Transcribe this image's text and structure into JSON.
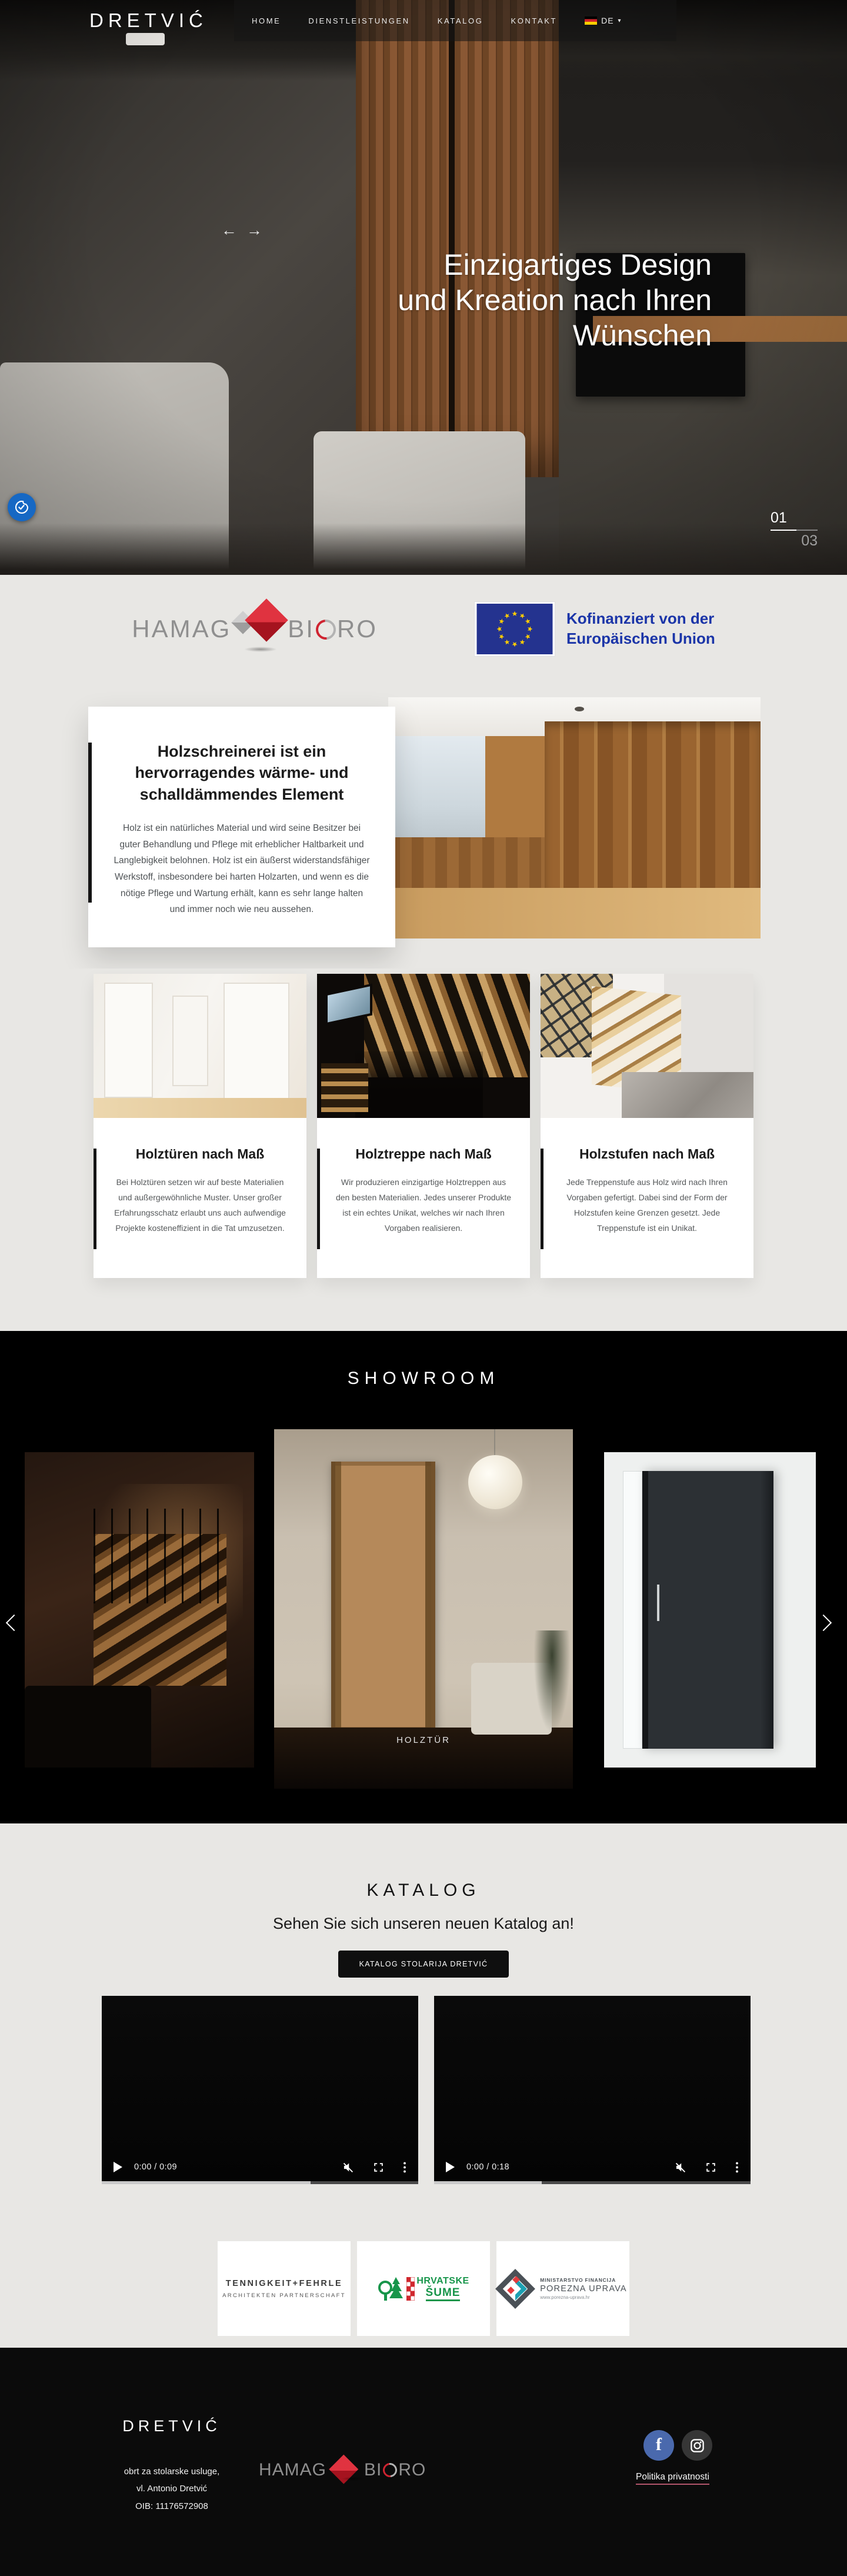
{
  "header": {
    "logo": "DRETVIĆ",
    "nav": [
      {
        "label": "HOME"
      },
      {
        "label": "DIENSTLEISTUNGEN"
      },
      {
        "label": "KATALOG"
      },
      {
        "label": "KONTAKT"
      }
    ],
    "lang": {
      "code": "DE"
    }
  },
  "hero": {
    "title_lines": [
      "Einzigartiges Design",
      "und Kreation nach Ihren",
      "Wünschen"
    ],
    "slide_current": "01",
    "slide_total": "03"
  },
  "sponsors": {
    "hamag": {
      "word1": "HAMAG",
      "word2_a": "BI",
      "word2_b": "RO"
    },
    "eu": {
      "line1": "Kofinanziert von der",
      "line2": "Europäischen Union"
    }
  },
  "feature": {
    "title": "Holzschreinerei ist ein hervorragendes wärme- und schalldämmendes Element",
    "body": "Holz ist ein natürliches Material und wird seine Besitzer bei guter Behandlung und Pflege mit erheblicher Haltbarkeit und Langlebigkeit belohnen. Holz ist ein äußerst widerstandsfähiger Werkstoff, insbesondere bei harten Holzarten, und wenn es die nötige Pflege und Wartung erhält, kann es sehr lange halten und immer noch wie neu aussehen."
  },
  "services": [
    {
      "title": "Holztüren nach Maß",
      "body": "Bei Holztüren setzen wir auf beste Materialien und außergewöhnliche Muster. Unser großer Erfahrungsschatz erlaubt uns auch aufwendige Projekte kosteneffizient in die Tat umzusetzen."
    },
    {
      "title": "Holztreppe nach Maß",
      "body": "Wir produzieren einzigartige Holztreppen aus den besten Materialien. Jedes unserer Produkte ist ein echtes Unikat, welches wir nach Ihren Vorgaben realisieren."
    },
    {
      "title": "Holzstufen nach Maß",
      "body": "Jede Treppenstufe aus Holz wird nach Ihren Vorgaben gefertigt. Dabei sind der Form der Holzstufen keine Grenzen gesetzt. Jede Treppenstufe ist ein Unikat."
    }
  ],
  "showroom": {
    "title": "SHOWROOM",
    "caption": "HOLZTÜR"
  },
  "katalog": {
    "title": "KATALOG",
    "subtitle": "Sehen Sie sich unseren neuen Katalog an!",
    "button": "KATALOG STOLARIJA DRETVIĆ",
    "videos": [
      {
        "time": "0:00 / 0:09",
        "progress_style": "width:66%"
      },
      {
        "time": "0:00 / 0:18",
        "progress_style": "width:34%"
      }
    ]
  },
  "partners": [
    {
      "line1": "TENNIGKEIT+FEHRLE",
      "line2": "ARCHITEKTEN PARTNERSCHAFT"
    },
    {
      "line1": "HRVATSKE",
      "line2": "ŠUME"
    },
    {
      "line1": "MINISTARSTVO FINANCIJA",
      "line2": "POREZNA UPRAVA",
      "line3": "www.porezna-uprava.hr"
    }
  ],
  "footer": {
    "logo": "DRETVIĆ",
    "address": [
      "obrt za stolarske usluge,",
      "vl. Antonio Dretvić",
      "OIB: 11176572908"
    ],
    "privacy": "Politika privatnosti"
  },
  "colors": {
    "page_bg": "#e8e7e4",
    "dark_section": "#000000",
    "footer_bg": "#0b0b0b",
    "eu_blue": "#1b35a8",
    "eu_flag_blue": "#24338f",
    "eu_star_yellow": "#ffcc00",
    "hamag_red": "#cf2330",
    "hamag_gray": "#8f8f8f",
    "cookie_blue": "#1668c4",
    "facebook_blue": "#4a69ad",
    "sume_green": "#17954a",
    "porezna_teal": "#1ba0b2",
    "porezna_red": "#e23b3e",
    "privacy_underline": "#b2556b",
    "flag_de": [
      "#000000",
      "#d2232a",
      "#ffce00"
    ]
  }
}
